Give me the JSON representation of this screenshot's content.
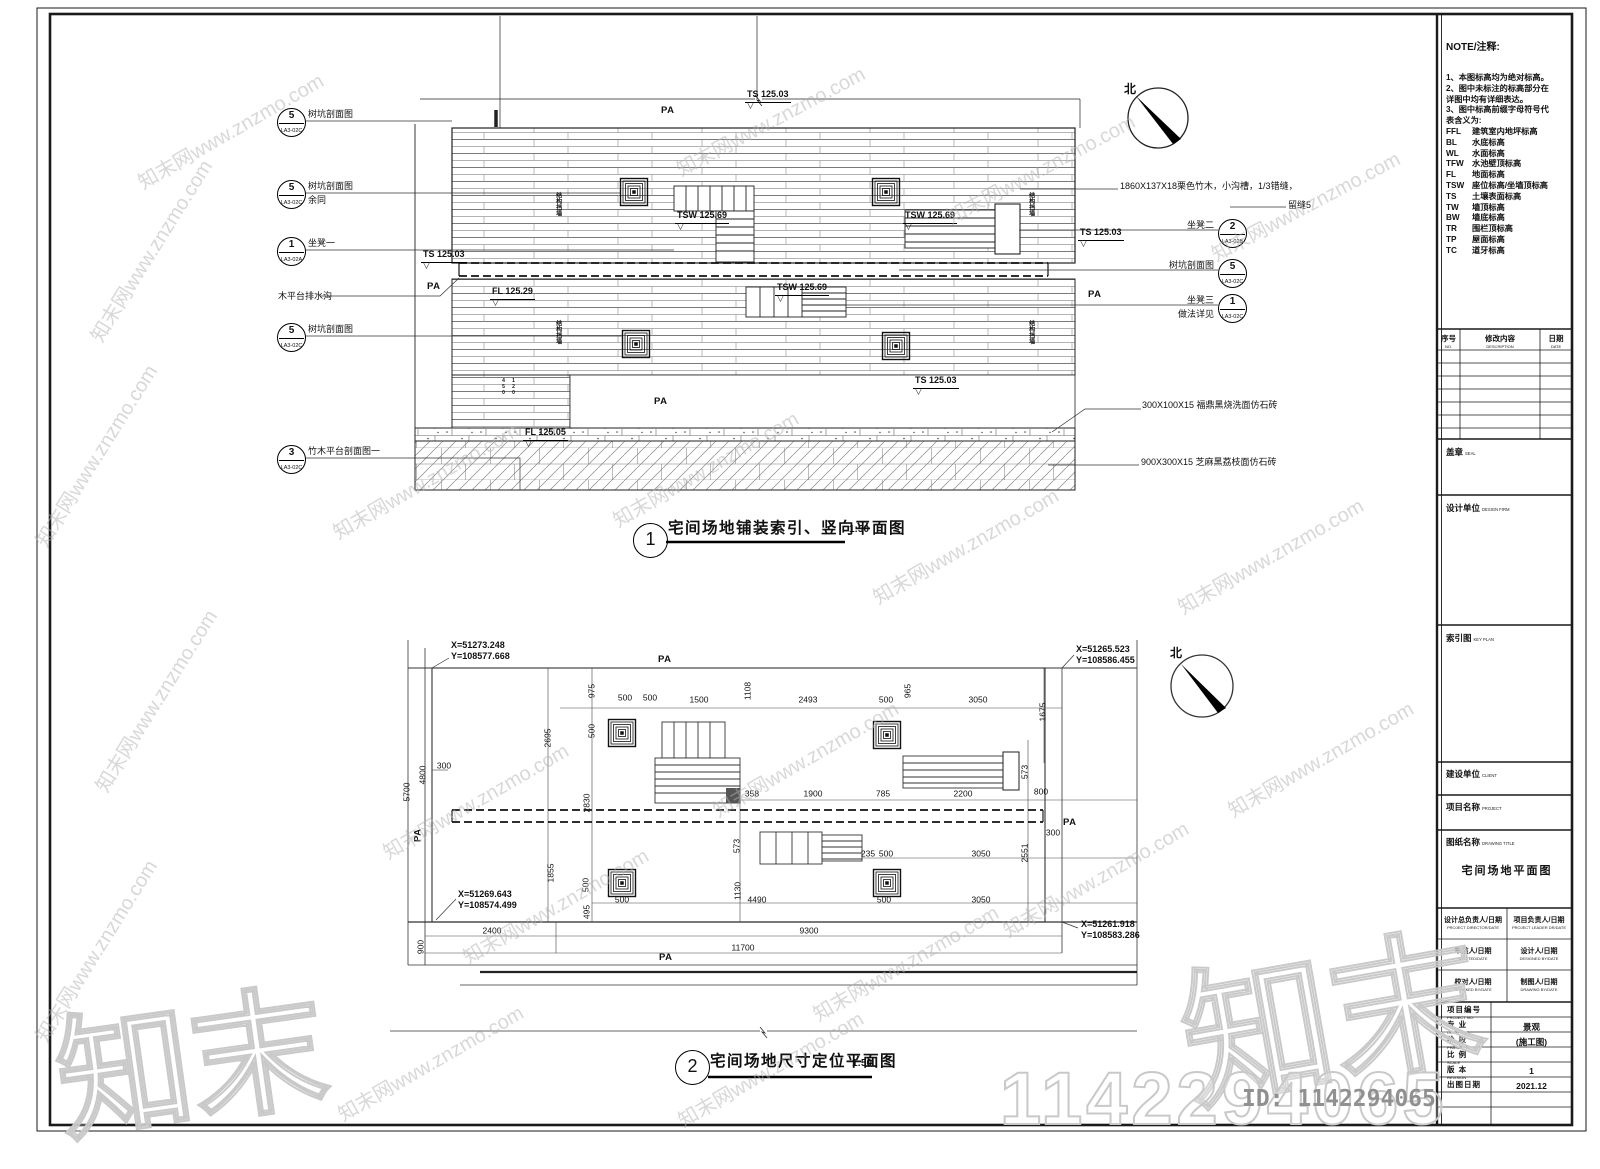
{
  "north_label": "北",
  "watermark": {
    "tile_text": "知末网www.znzmo.com",
    "logo_text": "知末",
    "big_number": "1142294065",
    "id_text": "ID: 1142294065",
    "color": "#c9c9c9",
    "tiles": [
      {
        "x": 150,
        "y": 250,
        "r": -58
      },
      {
        "x": 95,
        "y": 455,
        "r": -58
      },
      {
        "x": 230,
        "y": 130,
        "r": -30
      },
      {
        "x": 770,
        "y": 120,
        "r": -28
      },
      {
        "x": 1040,
        "y": 168,
        "r": -28
      },
      {
        "x": 1305,
        "y": 205,
        "r": -28
      },
      {
        "x": 425,
        "y": 480,
        "r": -30
      },
      {
        "x": 705,
        "y": 468,
        "r": -30
      },
      {
        "x": 965,
        "y": 545,
        "r": -30
      },
      {
        "x": 1270,
        "y": 555,
        "r": -30
      },
      {
        "x": 155,
        "y": 700,
        "r": -58
      },
      {
        "x": 95,
        "y": 950,
        "r": -58
      },
      {
        "x": 475,
        "y": 800,
        "r": -30
      },
      {
        "x": 805,
        "y": 758,
        "r": -30
      },
      {
        "x": 1095,
        "y": 878,
        "r": -30
      },
      {
        "x": 430,
        "y": 1062,
        "r": -30
      },
      {
        "x": 770,
        "y": 1068,
        "r": -30
      },
      {
        "x": 1320,
        "y": 758,
        "r": -30
      },
      {
        "x": 555,
        "y": 905,
        "r": -30
      },
      {
        "x": 905,
        "y": 962,
        "r": -30
      }
    ]
  },
  "plan1": {
    "title_num": "1",
    "title": "宅间场地铺装索引、竖向平面图",
    "scale": "1:50",
    "callouts": [
      {
        "num": "5",
        "code": "LA3-02C",
        "label": "树坑剖面图",
        "x": 277,
        "y": 108,
        "side": "left"
      },
      {
        "num": "5",
        "code": "LA3-02C",
        "label": "树坑剖面图",
        "label2": "余同",
        "x": 277,
        "y": 180,
        "side": "left"
      },
      {
        "num": "1",
        "code": "LA3-02A",
        "label": "坐凳一",
        "x": 277,
        "y": 237,
        "side": "left"
      },
      {
        "num": "5",
        "code": "LA3-02C",
        "label": "树坑剖面图",
        "x": 277,
        "y": 323,
        "side": "left"
      },
      {
        "num": "3",
        "code": "LA3-02C",
        "label": "竹木平台剖面图一",
        "x": 277,
        "y": 445,
        "side": "left"
      },
      {
        "num": "2",
        "code": "LA3-02B",
        "label": "坐凳二",
        "x": 1218,
        "y": 219,
        "side": "right"
      },
      {
        "num": "5",
        "code": "LA3-02C",
        "label": "树坑剖面图",
        "x": 1218,
        "y": 259,
        "side": "right"
      },
      {
        "num": "1",
        "code": "LA3-02C",
        "label": "坐凳三",
        "label2": "做法详见",
        "x": 1218,
        "y": 294,
        "side": "right"
      }
    ],
    "annotations": [
      {
        "t": "木平台排水沟",
        "x": 278,
        "y": 292
      },
      {
        "t": "1860X137X18栗色竹木，小沟槽，1/3错缝，",
        "x": 1120,
        "y": 182
      },
      {
        "t": "留缝5",
        "x": 1288,
        "y": 201
      },
      {
        "t": "300X100X15  福鼎黑烧洗面仿石砖",
        "x": 1142,
        "y": 401
      },
      {
        "t": "900X300X15  芝麻黑荔枝面仿石砖",
        "x": 1141,
        "y": 458
      }
    ],
    "elevations": [
      {
        "t": "TS 125.03",
        "x": 745,
        "y": 90
      },
      {
        "t": "TS 125.03",
        "x": 421,
        "y": 250
      },
      {
        "t": "TS 125.03",
        "x": 1078,
        "y": 228
      },
      {
        "t": "TSW 125.69",
        "x": 675,
        "y": 211
      },
      {
        "t": "TSW 125.69",
        "x": 903,
        "y": 211
      },
      {
        "t": "TSW 125.69",
        "x": 775,
        "y": 283
      },
      {
        "t": "FL 125.29",
        "x": 490,
        "y": 287
      },
      {
        "t": "TS 125.03",
        "x": 913,
        "y": 376
      },
      {
        "t": "FL 125.05",
        "x": 523,
        "y": 428
      }
    ],
    "pa": [
      {
        "t": "PA",
        "x": 661,
        "y": 106
      },
      {
        "t": "PA",
        "x": 427,
        "y": 282
      },
      {
        "t": "PA",
        "x": 1088,
        "y": 290
      },
      {
        "t": "PA",
        "x": 654,
        "y": 397
      }
    ],
    "vtexts": [
      {
        "t": "结构挡墙",
        "x": 554,
        "y": 192
      },
      {
        "t": "结构挡墙",
        "x": 554,
        "y": 320
      },
      {
        "t": "结构挡墙",
        "x": 1027,
        "y": 192
      },
      {
        "t": "结构挡墙",
        "x": 1027,
        "y": 320
      },
      {
        "t": "450",
        "x": 500,
        "y": 378,
        "s": 1
      },
      {
        "t": "120",
        "x": 510,
        "y": 378,
        "s": 1
      }
    ]
  },
  "plan2": {
    "title_num": "2",
    "title": "宅间场地尺寸定位平面图",
    "scale": "1:50",
    "coords": [
      {
        "x": "X=51273.248",
        "y": "Y=108577.668",
        "px": 451,
        "py": 640
      },
      {
        "x": "X=51265.523",
        "y": "Y=108586.455",
        "px": 1076,
        "py": 644
      },
      {
        "x": "X=51269.643",
        "y": "Y=108574.499",
        "px": 458,
        "py": 889
      },
      {
        "x": "X=51261.918",
        "y": "Y=108583.286",
        "px": 1081,
        "py": 919
      }
    ],
    "dims": [
      {
        "t": "975",
        "x": 592,
        "y": 691,
        "r": 1
      },
      {
        "t": "500",
        "x": 625,
        "y": 698
      },
      {
        "t": "500",
        "x": 650,
        "y": 698
      },
      {
        "t": "1500",
        "x": 699,
        "y": 700
      },
      {
        "t": "1108",
        "x": 748,
        "y": 691,
        "r": 1
      },
      {
        "t": "2493",
        "x": 808,
        "y": 700
      },
      {
        "t": "500",
        "x": 886,
        "y": 700
      },
      {
        "t": "965",
        "x": 908,
        "y": 691,
        "r": 1
      },
      {
        "t": "3050",
        "x": 978,
        "y": 700
      },
      {
        "t": "1675",
        "x": 1043,
        "y": 712,
        "r": 1
      },
      {
        "t": "2695",
        "x": 548,
        "y": 738,
        "r": 1
      },
      {
        "t": "500",
        "x": 592,
        "y": 731,
        "r": 1
      },
      {
        "t": "300",
        "x": 444,
        "y": 766
      },
      {
        "t": "4800",
        "x": 423,
        "y": 775,
        "r": 1
      },
      {
        "t": "5700",
        "x": 407,
        "y": 792,
        "r": 1
      },
      {
        "t": "2830",
        "x": 587,
        "y": 803,
        "r": 1
      },
      {
        "t": "358",
        "x": 752,
        "y": 794
      },
      {
        "t": "1900",
        "x": 813,
        "y": 794
      },
      {
        "t": "785",
        "x": 883,
        "y": 794
      },
      {
        "t": "2200",
        "x": 963,
        "y": 794
      },
      {
        "t": "800",
        "x": 1041,
        "y": 792
      },
      {
        "t": "573",
        "x": 1025,
        "y": 772,
        "r": 1
      },
      {
        "t": "573",
        "x": 737,
        "y": 846,
        "r": 1
      },
      {
        "t": "235",
        "x": 868,
        "y": 854
      },
      {
        "t": "500",
        "x": 886,
        "y": 854
      },
      {
        "t": "3050",
        "x": 981,
        "y": 854
      },
      {
        "t": "2551",
        "x": 1025,
        "y": 853,
        "r": 1
      },
      {
        "t": "300",
        "x": 1053,
        "y": 833
      },
      {
        "t": "1855",
        "x": 551,
        "y": 873,
        "r": 1
      },
      {
        "t": "500",
        "x": 586,
        "y": 885,
        "r": 1
      },
      {
        "t": "495",
        "x": 587,
        "y": 912,
        "r": 1
      },
      {
        "t": "1130",
        "x": 738,
        "y": 891,
        "r": 1
      },
      {
        "t": "500",
        "x": 622,
        "y": 900
      },
      {
        "t": "4490",
        "x": 757,
        "y": 900
      },
      {
        "t": "500",
        "x": 884,
        "y": 900
      },
      {
        "t": "3050",
        "x": 981,
        "y": 900
      },
      {
        "t": "900",
        "x": 421,
        "y": 947,
        "r": 1
      },
      {
        "t": "2400",
        "x": 492,
        "y": 931
      },
      {
        "t": "9300",
        "x": 809,
        "y": 931
      },
      {
        "t": "11700",
        "x": 743,
        "y": 948
      }
    ],
    "pa": [
      {
        "t": "PA",
        "x": 658,
        "y": 655
      },
      {
        "t": "PA",
        "x": 412,
        "y": 830,
        "r": 1
      },
      {
        "t": "PA",
        "x": 1063,
        "y": 818
      },
      {
        "t": "PA",
        "x": 659,
        "y": 953
      }
    ]
  },
  "titleblock": {
    "note_title": "NOTE/注释:",
    "notes": [
      "1、本图标高均为绝对标高。",
      "2、图中未标注的标高部分在",
      "详图中均有详细表达。",
      "3、图中标高前缀字母符号代",
      "表含义为:"
    ],
    "abbrs": [
      [
        "FFL",
        "建筑室内地坪标高"
      ],
      [
        "BL",
        "水底标高"
      ],
      [
        "WL",
        "水面标高"
      ],
      [
        "TFW",
        "水池壁顶标高"
      ],
      [
        "FL",
        "地面标高"
      ],
      [
        "TSW",
        "座位标高/坐墙顶标高"
      ],
      [
        "TS",
        "土壤表面标高"
      ],
      [
        "TW",
        "墙顶标高"
      ],
      [
        "BW",
        "墙底标高"
      ],
      [
        "TR",
        "围栏顶标高"
      ],
      [
        "TP",
        "屋面标高"
      ],
      [
        "TC",
        "道牙标高"
      ]
    ],
    "rev_cols": [
      {
        "zh": "序号",
        "en": "NO."
      },
      {
        "zh": "修改内容",
        "en": "DESCRIPTION"
      },
      {
        "zh": "日期",
        "en": "DATE"
      }
    ],
    "sections": {
      "seal": [
        "盖章",
        "SEAL"
      ],
      "design_firm": [
        "设计单位",
        "DESIGN FIRM"
      ],
      "key_plan": [
        "索引图",
        "KEY PLAN"
      ],
      "client": [
        "建设单位",
        "CLIENT"
      ],
      "project": [
        "项目名称",
        "PROJECT"
      ],
      "drawing_title": [
        "图纸名称",
        "DRAWING TITLE"
      ]
    },
    "drawing_title_value": "宅间场地平面图",
    "staff": [
      [
        "设计总负责人/日期",
        "PROJECT DIRECTOR/DATE"
      ],
      [
        "项目负责人/日期",
        "PROJECT LEADER DR/DATE"
      ],
      [
        "审核人/日期",
        "AUDITED/DATE"
      ],
      [
        "设计人/日期",
        "DESIGNED BY/DATE"
      ],
      [
        "校对人/日期",
        "CHECKED BY/DATE"
      ],
      [
        "制图人/日期",
        "DRAWING BY/DATE"
      ]
    ],
    "info_rows": [
      {
        "zh": "项目编号",
        "en": "PROJECT NO.",
        "val": ""
      },
      {
        "zh": "专 业",
        "en": "DISCIPLINE",
        "val": "景观"
      },
      {
        "zh": "阶 段",
        "en": "PHASE",
        "val": "(施工图)"
      },
      {
        "zh": "比 例",
        "en": "SCALE",
        "val": ""
      },
      {
        "zh": "版 本",
        "en": "REVISION",
        "val": "1"
      },
      {
        "zh": "出图日期",
        "en": "",
        "val": "2021.12"
      },
      {
        "zh": "",
        "en": "",
        "val": ""
      },
      {
        "zh": "",
        "en": "",
        "val": ""
      }
    ]
  }
}
